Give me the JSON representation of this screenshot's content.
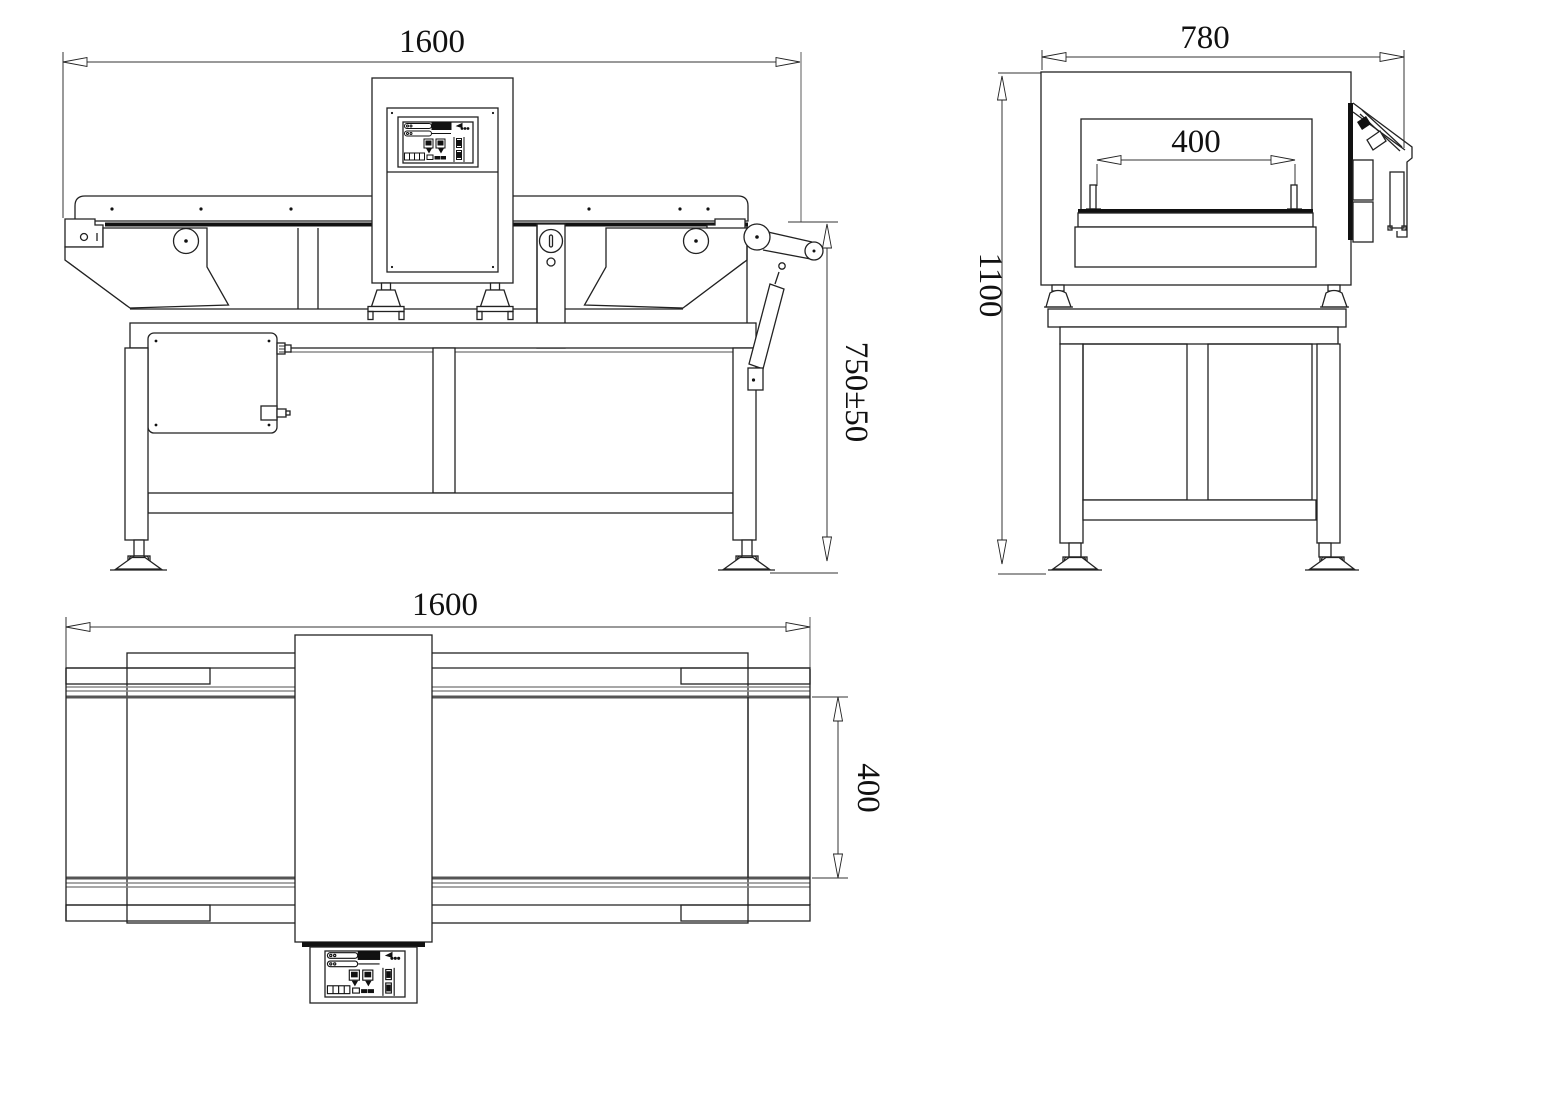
{
  "drawing": {
    "type": "engineering-three-view",
    "subject": "conveyor metal detector machine",
    "front_view": {
      "label": "front-view",
      "dims": {
        "width": "1600",
        "belt_height": "750±50"
      }
    },
    "side_view": {
      "label": "side-view",
      "dims": {
        "width": "780",
        "height": "1100",
        "belt_width": "400"
      }
    },
    "top_view": {
      "label": "top-view",
      "dims": {
        "length": "1600",
        "belt_width": "400"
      }
    },
    "colors": {
      "line": "#222222",
      "gray": "#8a8a8a",
      "background": "#ffffff"
    }
  }
}
